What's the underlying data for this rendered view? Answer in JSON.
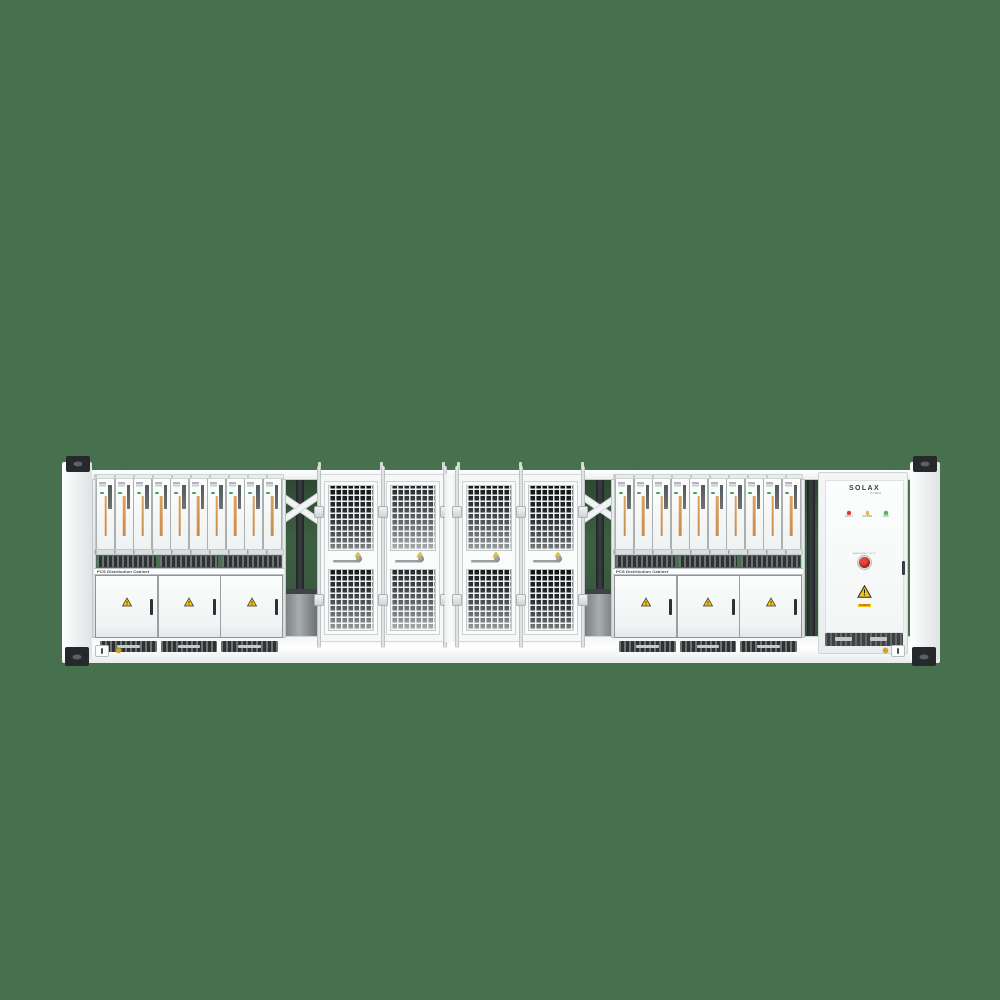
{
  "colors": {
    "background": "#47704E",
    "container_body": "#F4F6F6",
    "module_strip_orange": "#D39A5C",
    "module_led_green": "#45A34E",
    "warning_yellow": "#F2C514",
    "estop_red": "#B72417",
    "led_red": "#E0392B",
    "led_yellow": "#E8B93C",
    "led_green": "#53B657"
  },
  "racks": {
    "module_count": 10,
    "door_count": 3,
    "vent_segment_count": 3,
    "label": "PCS Distribution Cabinet"
  },
  "mesh_section": {
    "groups": 2,
    "doors_per_group": 2
  },
  "solax_cabinet": {
    "brand": "SOLAX",
    "brand_sub": "POWER",
    "leds": [
      {
        "name": "fault-led",
        "color": "#E0392B",
        "label": "FAULT"
      },
      {
        "name": "power-led",
        "color": "#E8B93C",
        "label": "POWER"
      },
      {
        "name": "run-led",
        "color": "#53B657",
        "label": "RUN"
      }
    ],
    "estop_label": "EMERGENCY STOP",
    "warning_caption": "DANGER"
  }
}
